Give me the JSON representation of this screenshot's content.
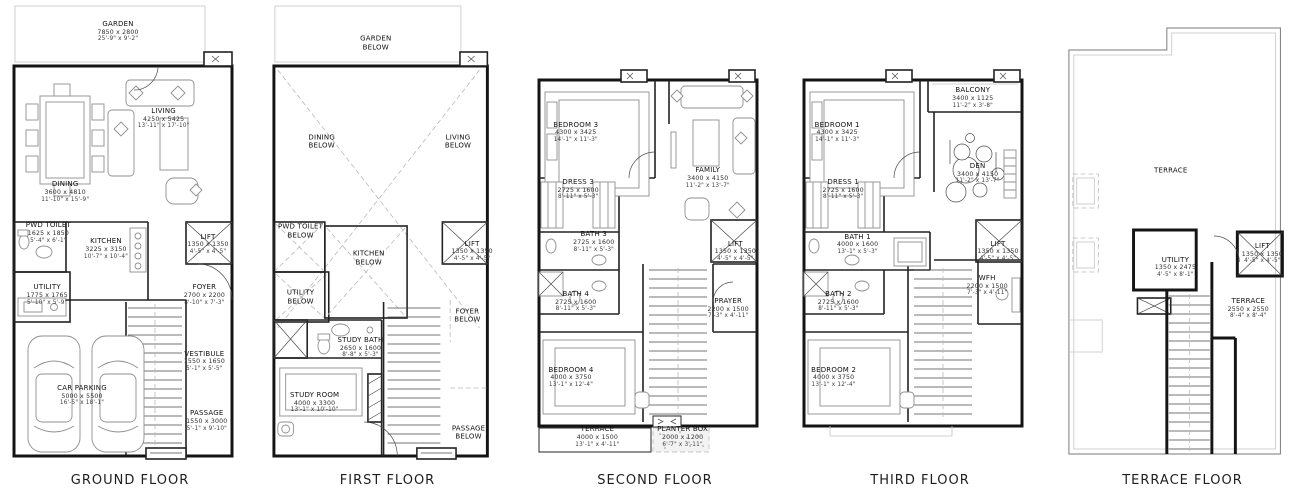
{
  "colors": {
    "wall": "#141414",
    "furniture_line": "#8f8f8f",
    "text": "#101010",
    "background": "#ffffff"
  },
  "floors": [
    {
      "id": "ground",
      "label": "GROUND FLOOR",
      "rooms": [
        {
          "name": "GARDEN",
          "mm": "7850 x 2800",
          "ft": "25'-9\" x 9'-2\"",
          "x": 45,
          "y": 6.5
        },
        {
          "name": "LIVING",
          "mm": "4250 x 5425",
          "ft": "13'-11\" x 17'-10\"",
          "x": 64,
          "y": 25.5
        },
        {
          "name": "DINING",
          "mm": "3600 x 4810",
          "ft": "11'-10\" x 15'-9\"",
          "x": 23,
          "y": 41.5
        },
        {
          "name": "PWD TOILET",
          "mm": "1625 x 1850",
          "ft": "5'-4\" x 6'-1\"",
          "x": 16,
          "y": 50.5
        },
        {
          "name": "KITCHEN",
          "mm": "3225 x 3150",
          "ft": "10'-7\" x 10'-4\"",
          "x": 40,
          "y": 54
        },
        {
          "name": "LIFT",
          "mm": "1350 x 1350",
          "ft": "4'-5\" x 4'-5\"",
          "x": 82.5,
          "y": 53
        },
        {
          "name": "UTILITY",
          "mm": "1775 x 1765",
          "ft": "5'-10\" x 5'-9\"",
          "x": 15.5,
          "y": 64
        },
        {
          "name": "FOYER",
          "mm": "2700 x 2200",
          "ft": "8'-10\" x 7'-3\"",
          "x": 81,
          "y": 64
        },
        {
          "name": "VESTIBULE",
          "mm": "1550 x 1650",
          "ft": "5'-1\" x 5'-5\"",
          "x": 81,
          "y": 78.5
        },
        {
          "name": "CAR PARKING",
          "mm": "5000 x 5500",
          "ft": "16'-5\" x 18'-1\"",
          "x": 30,
          "y": 86
        },
        {
          "name": "PASSAGE",
          "mm": "1550 x 3000",
          "ft": "5'-1\" x 9'-10\"",
          "x": 82,
          "y": 91.5
        }
      ]
    },
    {
      "id": "first",
      "label": "FIRST FLOOR",
      "rooms": [
        {
          "name": "GARDEN",
          "sub": "BELOW",
          "x": 45,
          "y": 9
        },
        {
          "name": "DINING",
          "sub": "BELOW",
          "x": 22,
          "y": 30.5
        },
        {
          "name": "LIVING",
          "sub": "BELOW",
          "x": 80,
          "y": 30.5
        },
        {
          "name": "PWD TOILET",
          "sub": "BELOW",
          "x": 13,
          "y": 50
        },
        {
          "name": "KITCHEN",
          "sub": "BELOW",
          "x": 42,
          "y": 56
        },
        {
          "name": "LIFT",
          "mm": "1350 x 1350",
          "ft": "4'-5\" x 4'-5\"",
          "x": 86,
          "y": 54.5
        },
        {
          "name": "UTILITY",
          "sub": "BELOW",
          "x": 13,
          "y": 64.5
        },
        {
          "name": "FOYER",
          "sub": "BELOW",
          "x": 84,
          "y": 68.5
        },
        {
          "name": "STUDY BATH",
          "mm": "2650 x 1600",
          "ft": "8'-8\" x 5'-3\"",
          "x": 38.5,
          "y": 75.5
        },
        {
          "name": "STUDY ROOM",
          "mm": "4000 x 3300",
          "ft": "13'-1\" x 10'-10\"",
          "x": 19,
          "y": 87.5
        },
        {
          "name": "PASSAGE",
          "sub": "BELOW",
          "x": 84.5,
          "y": 94
        }
      ]
    },
    {
      "id": "second",
      "label": "SECOND FLOOR",
      "rooms": [
        {
          "name": "BEDROOM 3",
          "mm": "4300 x 3425",
          "ft": "14'-1\" x 11'-3\"",
          "x": 17,
          "y": 28.5
        },
        {
          "name": "FAMILY",
          "mm": "3400 x 4150",
          "ft": "11'-2\" x 13'-7\"",
          "x": 72,
          "y": 38.5
        },
        {
          "name": "DRESS 3",
          "mm": "2725 x 1600",
          "ft": "8'-11\" x 5'-3\"",
          "x": 18,
          "y": 41
        },
        {
          "name": "BATH 3",
          "mm": "2725 x 1600",
          "ft": "8'-11\" x 5'-3\"",
          "x": 24.5,
          "y": 52.5
        },
        {
          "name": "LIFT",
          "mm": "1350 x 1350",
          "ft": "4'-5\" x 4'-5\"",
          "x": 83.5,
          "y": 54.5
        },
        {
          "name": "BATH 4",
          "mm": "2725 x 1600",
          "ft": "8'-11\" x 5'-3\"",
          "x": 17,
          "y": 65.5
        },
        {
          "name": "PRAYER",
          "mm": "2200 x 1500",
          "ft": "7'-3\" x 4'-11\"",
          "x": 80.5,
          "y": 67
        },
        {
          "name": "BEDROOM 4",
          "mm": "4000 x 3750",
          "ft": "13'-1\" x 12'-4\"",
          "x": 15,
          "y": 82
        },
        {
          "name": "TERRACE",
          "mm": "4000 x 1500",
          "ft": "13'-1\" x 4'-11\"",
          "x": 26,
          "y": 95
        },
        {
          "name": "PLANTER BOX",
          "mm": "2000 x 1200",
          "ft": "6'-7\" x 3'-11\"",
          "x": 61.5,
          "y": 95
        }
      ]
    },
    {
      "id": "third",
      "label": "THIRD FLOOR",
      "rooms": [
        {
          "name": "BEDROOM 1",
          "mm": "4300 x 3425",
          "ft": "14'-1\" x 11'-3\"",
          "x": 15.5,
          "y": 28.5
        },
        {
          "name": "BALCONY",
          "mm": "3400 x 1125",
          "ft": "11'-2\" x 3'-8\"",
          "x": 72,
          "y": 21
        },
        {
          "name": "DEN",
          "mm": "3400 x 4150",
          "ft": "11'-2\" x 13'-7\"",
          "x": 74,
          "y": 37.5
        },
        {
          "name": "DRESS 1",
          "mm": "2725 x 1600",
          "ft": "8'-11\" x 5'-3\"",
          "x": 18,
          "y": 41
        },
        {
          "name": "BATH 1",
          "mm": "4000 x 1600",
          "ft": "13'-1\" x 5'-3\"",
          "x": 24,
          "y": 53
        },
        {
          "name": "LIFT",
          "mm": "1350 x 1350",
          "ft": "4'-5\" x 4'-5\"",
          "x": 82.5,
          "y": 54.5
        },
        {
          "name": "BATH 2",
          "mm": "2725 x 1600",
          "ft": "8'-11\" x 5'-3\"",
          "x": 16,
          "y": 65.5
        },
        {
          "name": "WFH",
          "mm": "2200 x 1500",
          "ft": "7'-3\" x 4'-11\"",
          "x": 78,
          "y": 62
        },
        {
          "name": "BEDROOM 2",
          "mm": "4000 x 3750",
          "ft": "13'-1\" x 12'-4\"",
          "x": 14,
          "y": 82
        }
      ]
    },
    {
      "id": "terrace",
      "label": "TERRACE FLOOR",
      "rooms": [
        {
          "name": "TERRACE",
          "x": 45,
          "y": 37
        },
        {
          "name": "UTILITY",
          "mm": "1350 x 2475",
          "ft": "4'-5\" x 8'-1\"",
          "x": 47,
          "y": 58
        },
        {
          "name": "LIFT",
          "mm": "1350 x 1350",
          "ft": "4'-5\" x 4'-5\"",
          "x": 84,
          "y": 55
        },
        {
          "name": "TERRACE",
          "mm": "2550 x 2550",
          "ft": "8'-4\" x 8'-4\"",
          "x": 78,
          "y": 67
        }
      ]
    }
  ]
}
